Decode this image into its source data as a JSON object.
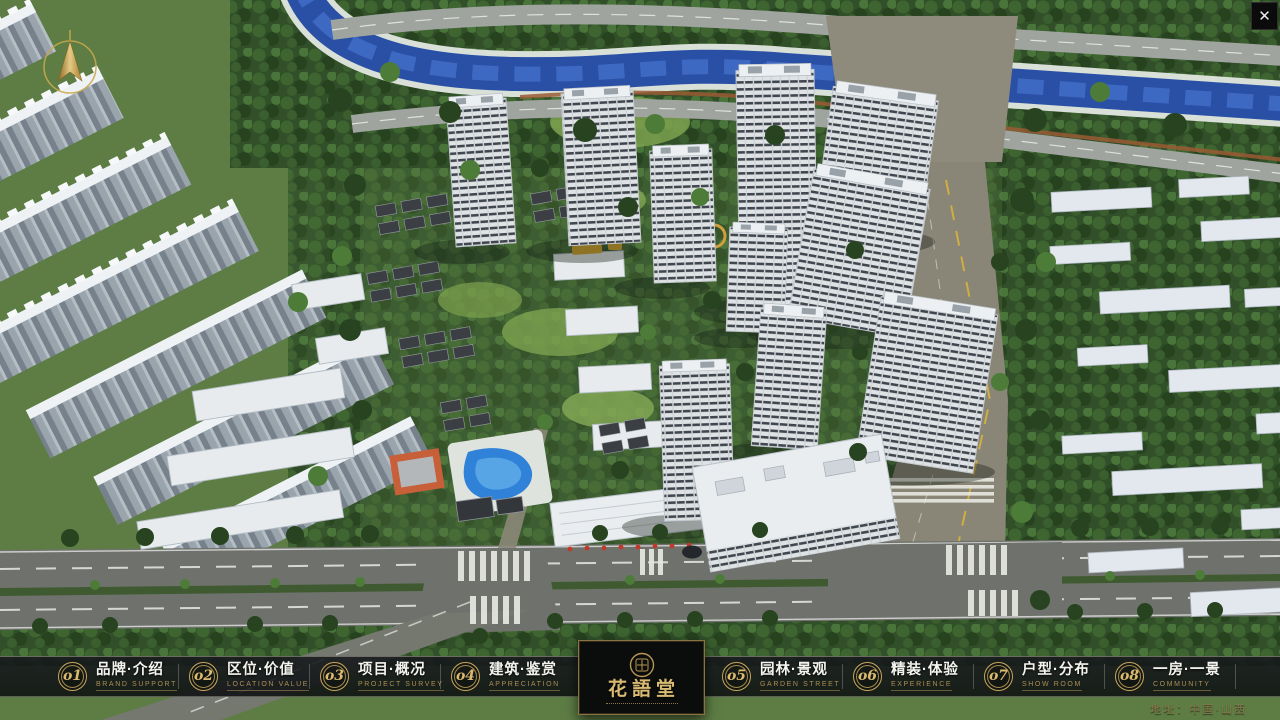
{
  "window": {
    "close_glyph": "✕"
  },
  "logo": {
    "name_zh": "花語堂"
  },
  "menu": {
    "items": [
      {
        "num": "o1",
        "zh": "品牌·介绍",
        "en": "BRAND SUPPORT"
      },
      {
        "num": "o2",
        "zh": "区位·价值",
        "en": "LOCATION VALUE"
      },
      {
        "num": "o3",
        "zh": "项目·概况",
        "en": "PROJECT SURVEY"
      },
      {
        "num": "o4",
        "zh": "建筑·鉴赏",
        "en": "APPRECIATION"
      },
      {
        "num": "o5",
        "zh": "园林·景观",
        "en": "GARDEN STREET"
      },
      {
        "num": "o6",
        "zh": "精装·体验",
        "en": "EXPERIENCE"
      },
      {
        "num": "o7",
        "zh": "户型·分布",
        "en": "SHOW ROOM"
      },
      {
        "num": "o8",
        "zh": "一房·一景",
        "en": "COMMUNITY"
      }
    ]
  },
  "footer": {
    "address": "地址：中国·山西"
  },
  "palette": {
    "gold_accent": "#c9a85c",
    "bar_background": "#14171a",
    "river_water": "#2a50a6",
    "tree_dark_green": "#31502a",
    "road_grey": "#6f726c",
    "tower_facade": "#dfe3e6"
  }
}
